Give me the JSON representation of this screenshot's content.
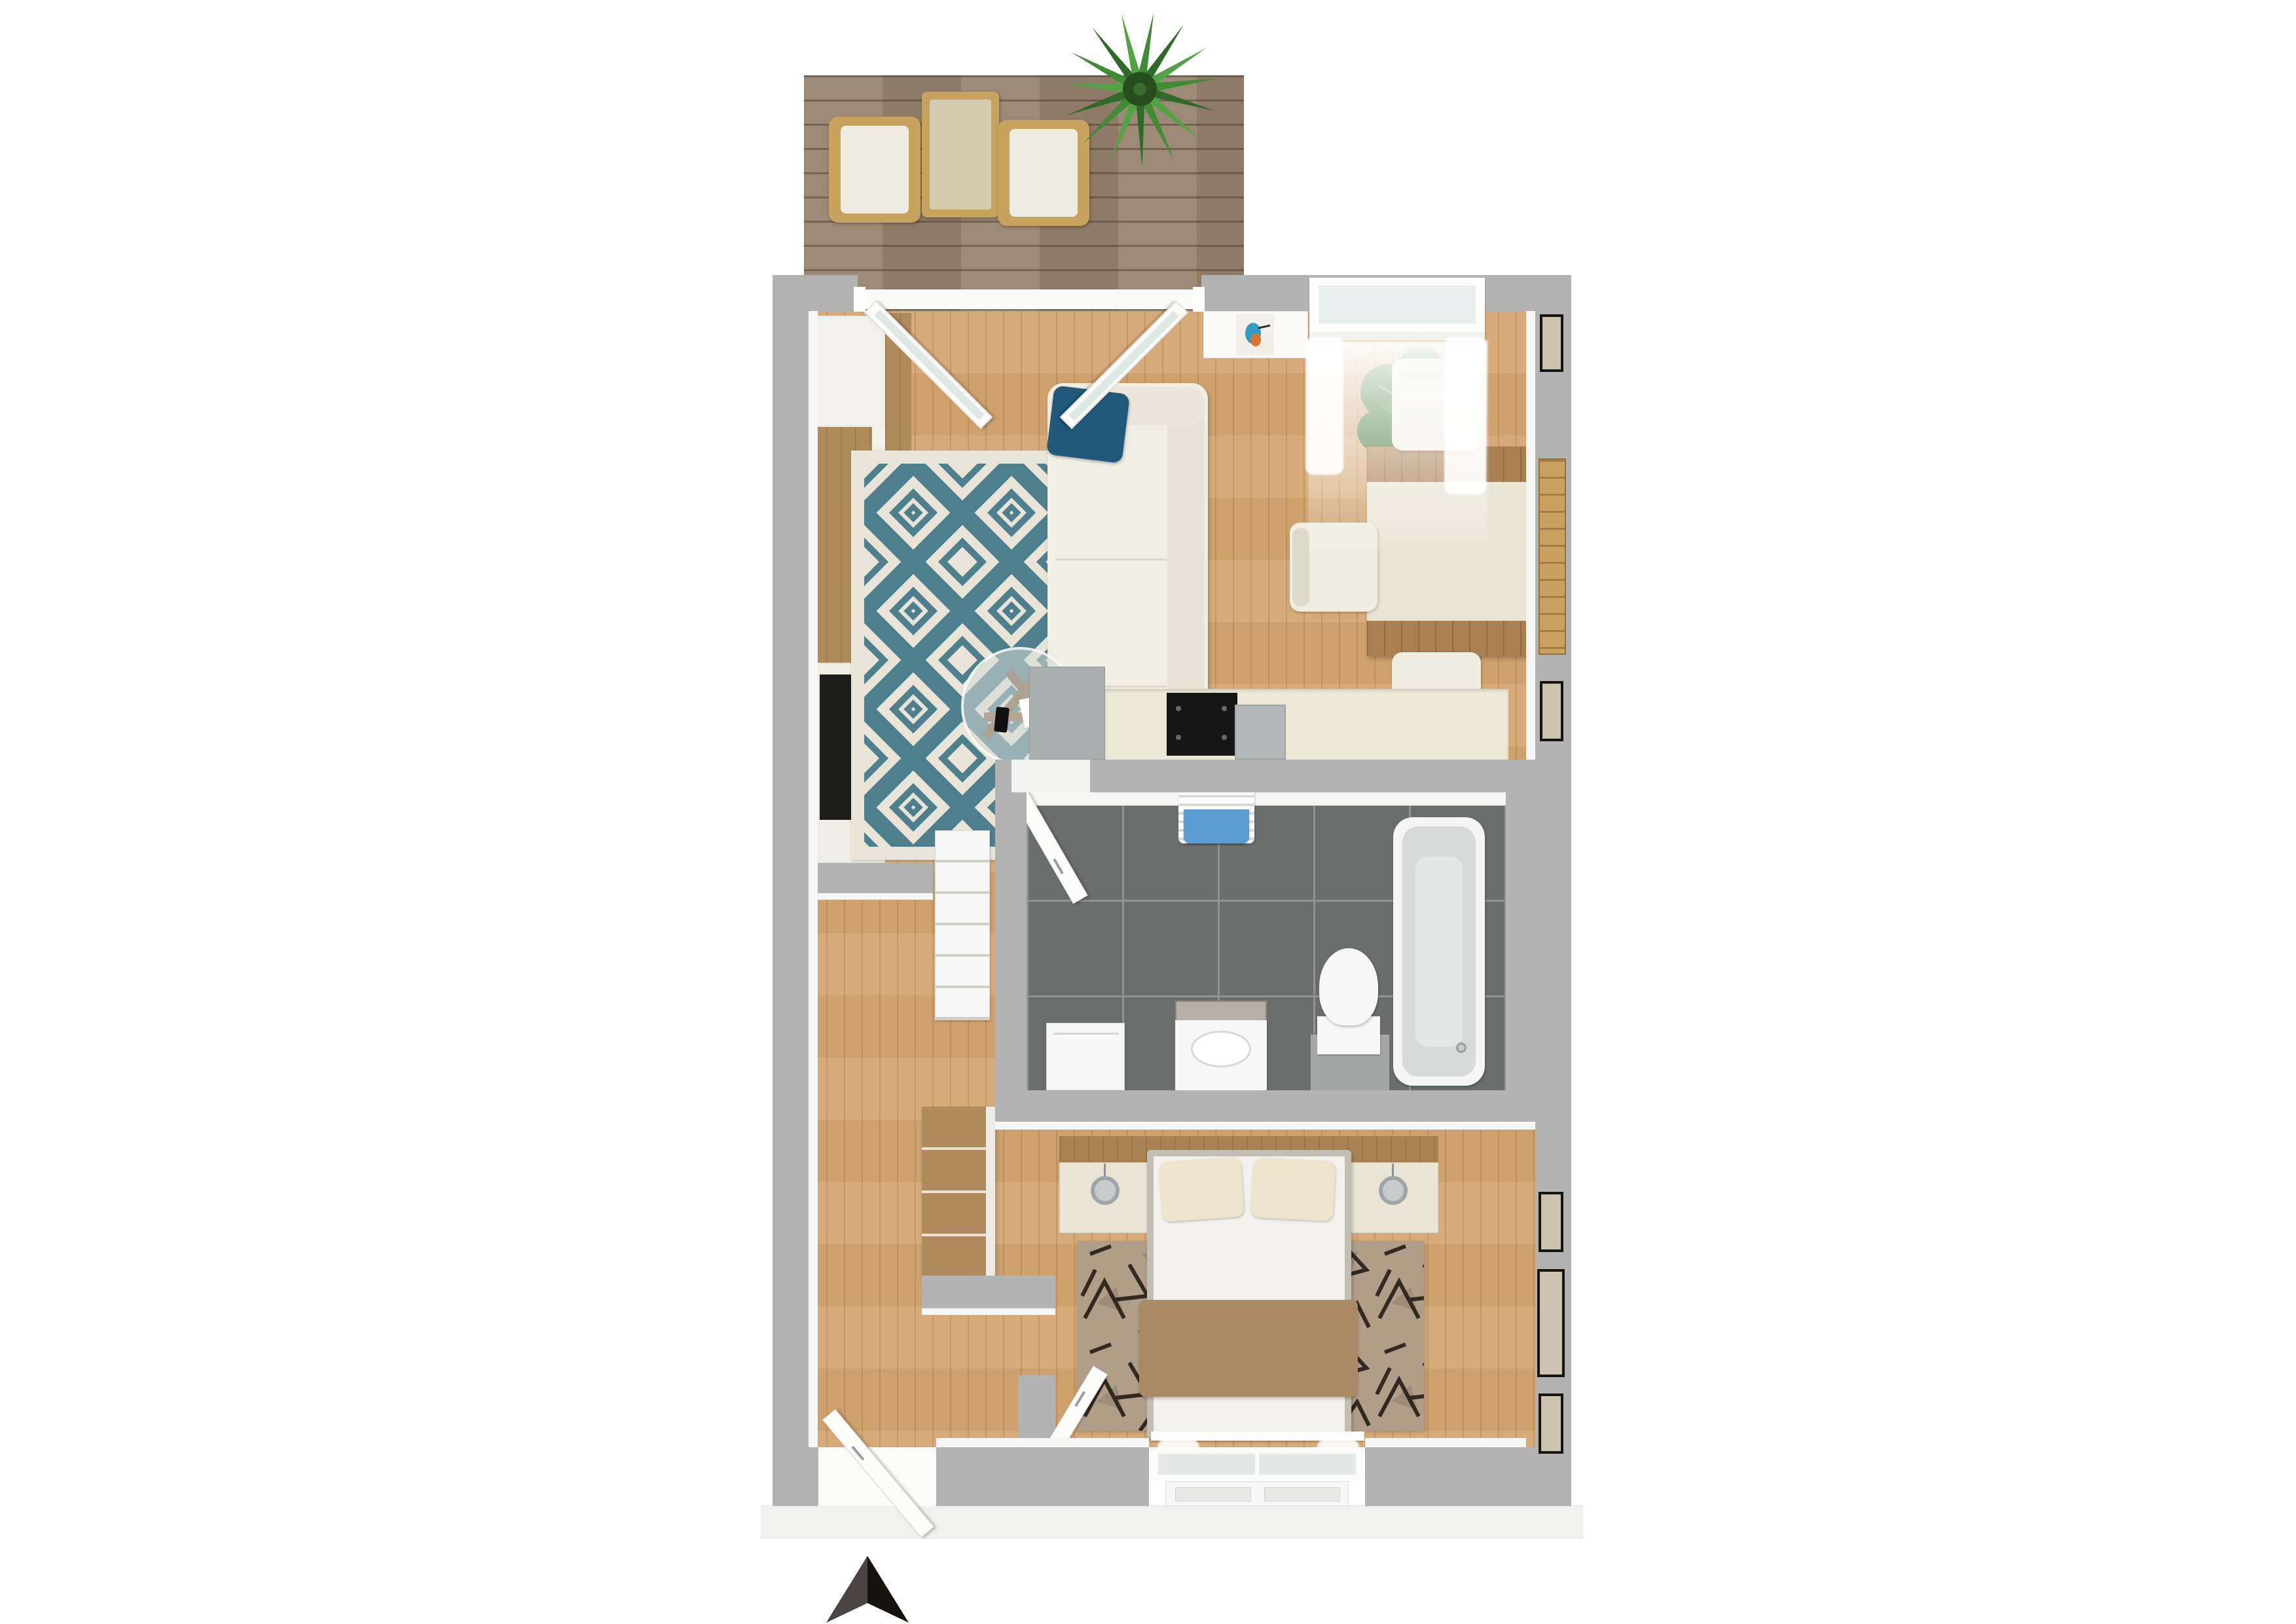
{
  "scene": {
    "kind": "top-down 3D floor plan render of a one-bedroom apartment",
    "compass": "two-tone north arrow below plan, pointing up"
  },
  "palette": {
    "wall": "#b3b3b3",
    "wall_face": "#f6f6f4",
    "wood_floor": "#d4a772",
    "deck": "#97836f",
    "tile": "#6a6f6e",
    "tile_grout": "#8f9493",
    "counter": "#ece7d6",
    "cooktop": "#161616",
    "kitchen_unit": "#a9aeae",
    "cream": "#efece2",
    "white_fixture": "#f6f7f6",
    "wood_furniture": "#b08b5e",
    "rug_living_base": "#e9e4d8",
    "rug_living_accent": "#4e7f8c",
    "rug_bedroom_base": "#b19e89",
    "rug_bedroom_accent": "#241c15",
    "sofa": "#f0ede3",
    "throw_accent": "#20587a",
    "blanket": "#aa8a65",
    "bed_frame": "#c2beb4",
    "bed_linen": "#f3f1ee",
    "pillow": "#ece4cd",
    "plant_dark": "#2e6b28",
    "plant_light": "#3e8c33",
    "towel": "#5b9bd0",
    "chrome": "#c7cbcb",
    "arrow_left": "#4a4542",
    "arrow_right": "#16130f"
  },
  "rooms": {
    "balcony": {
      "items": [
        "wood-deck",
        "rattan-chair",
        "rattan-chair",
        "rattan-table",
        "palm-plant"
      ]
    },
    "living_room": {
      "items": [
        "french-doors",
        "white-cabinet",
        "wood-wardrobe-panel",
        "wall-shelf",
        "tv-bench",
        "tv",
        "diamond-rug",
        "sofa",
        "teal-throw",
        "glass-coffee-table",
        "magazine",
        "phone"
      ]
    },
    "dining_area": {
      "items": [
        "window-with-sheer-curtains",
        "art-niche-kingfisher-picture",
        "potted-plant",
        "dining-table-with-runner",
        "chair",
        "chair",
        "chair",
        "tall-wall-art",
        "black-framed-picture",
        "black-framed-picture"
      ]
    },
    "kitchen": {
      "items": [
        "tall-gray-unit",
        "counter",
        "cooktop",
        "sink"
      ]
    },
    "bathroom": {
      "items": [
        "open-door",
        "towel-radiator",
        "blue-towel",
        "bathtub",
        "faucet",
        "toilet",
        "pedestal-sink",
        "backsplash-mirror",
        "washing-machine",
        "dark-tile-floor"
      ]
    },
    "hallway": {
      "items": [
        "ladder-shelf-cabinet",
        "hall-closet",
        "entry-door-open"
      ]
    },
    "bedroom": {
      "items": [
        "open-door",
        "headboard-panel",
        "nightstand",
        "nightstand",
        "pendant-lamp",
        "pendant-lamp",
        "double-bed",
        "pillow",
        "pillow",
        "tan-blanket",
        "berber-rug",
        "window",
        "radiator",
        "sheer-curtains",
        "framed-picture",
        "framed-picture",
        "framed-picture"
      ]
    }
  },
  "icons": {
    "north_arrow": "compass arrow glyph, dark-gray left half and black right half"
  }
}
